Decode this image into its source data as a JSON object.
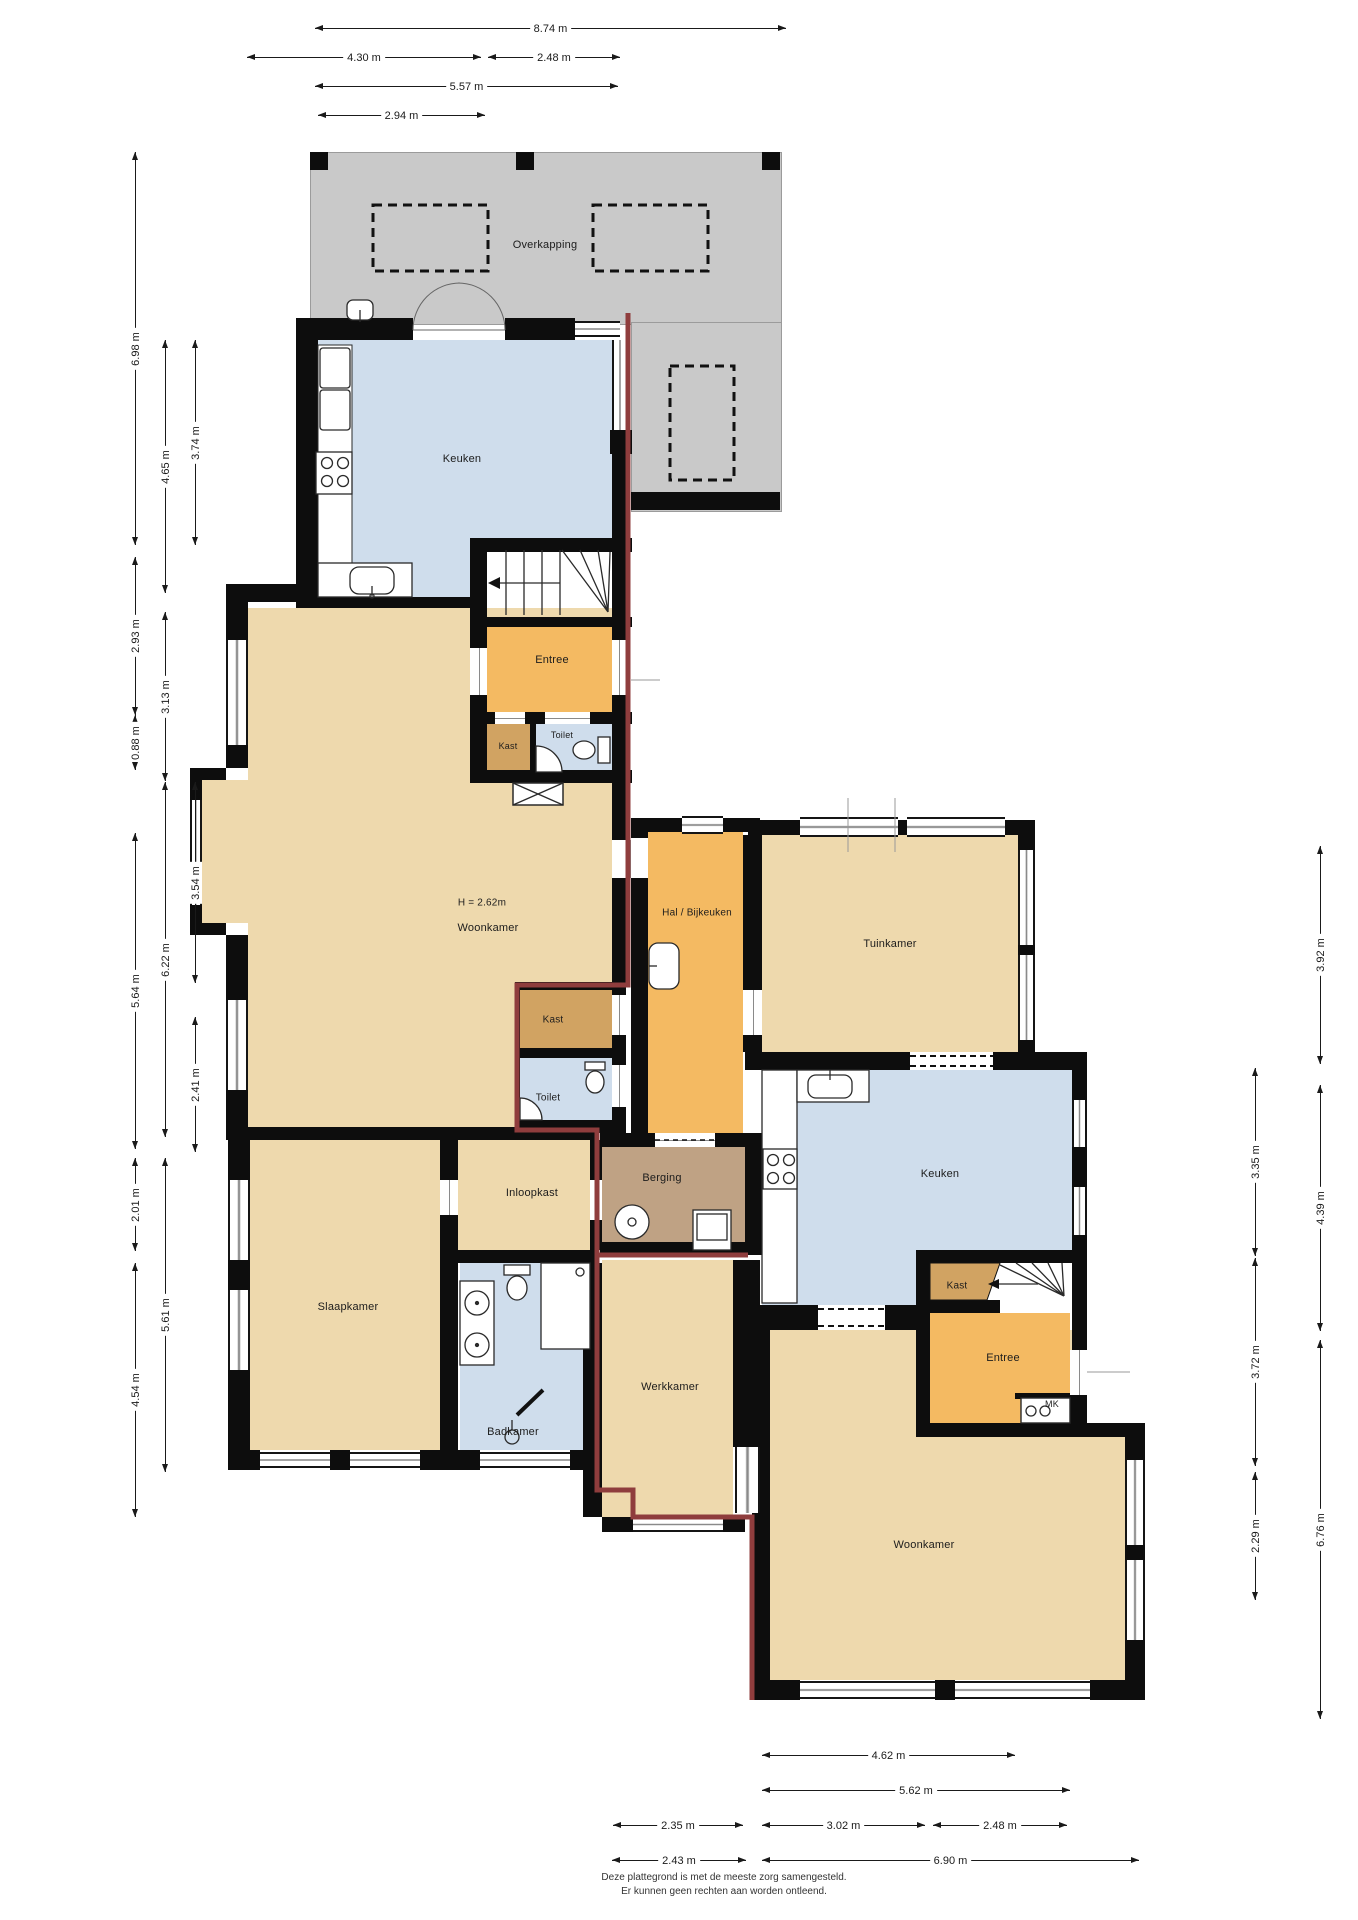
{
  "rooms": {
    "overkapping": "Overkapping",
    "keuken_boven": "Keuken",
    "entree_boven": "Entree",
    "kast_boven": "Kast",
    "toilet_boven": "Toilet",
    "hoogte_note": "H = 2.62m",
    "woonkamer_links": "Woonkamer",
    "hal": "Hal / Bijkeuken",
    "tuinkamer": "Tuinkamer",
    "kast_midden": "Kast",
    "toilet_midden": "Toilet",
    "inloopkast": "Inloopkast",
    "berging": "Berging",
    "slaapkamer": "Slaapkamer",
    "badkamer": "Badkamer",
    "werkkamer": "Werkkamer",
    "keuken_rechts": "Keuken",
    "kast_rechts": "Kast",
    "entree_rechts": "Entree",
    "mk": "MK",
    "woonkamer_rechts": "Woonkamer"
  },
  "dims": [
    "8.74 m",
    "4.30 m",
    "2.48 m",
    "5.57 m",
    "2.94 m",
    "6.98 m",
    "2.93 m",
    "0.88 m",
    "5.64 m",
    "2.01 m",
    "4.54 m",
    "4.65 m",
    "3.13 m",
    "6.22 m",
    "5.61 m",
    "3.74 m",
    "3.54 m",
    "2.41 m",
    "3.35 m",
    "3.72 m",
    "2.29 m",
    "3.92 m",
    "4.39 m",
    "6.76 m",
    "4.62 m",
    "5.62 m",
    "2.35 m",
    "3.02 m",
    "2.48 m",
    "2.43 m",
    "6.90 m"
  ],
  "footer": {
    "line1": "Deze plattegrond is met de meeste zorg samengesteld.",
    "line2": "Er kunnen geen rechten aan worden ontleend."
  },
  "colors": {
    "wall": "#0d0d0d",
    "room_tan": "#eed9ad",
    "room_orange": "#f4ba62",
    "room_closet": "#d1a362",
    "room_storage": "#bfa284",
    "room_wet": "#cfddec",
    "canopy_grey": "#c9c9c9",
    "boundary_red": "#8f3d3d"
  }
}
